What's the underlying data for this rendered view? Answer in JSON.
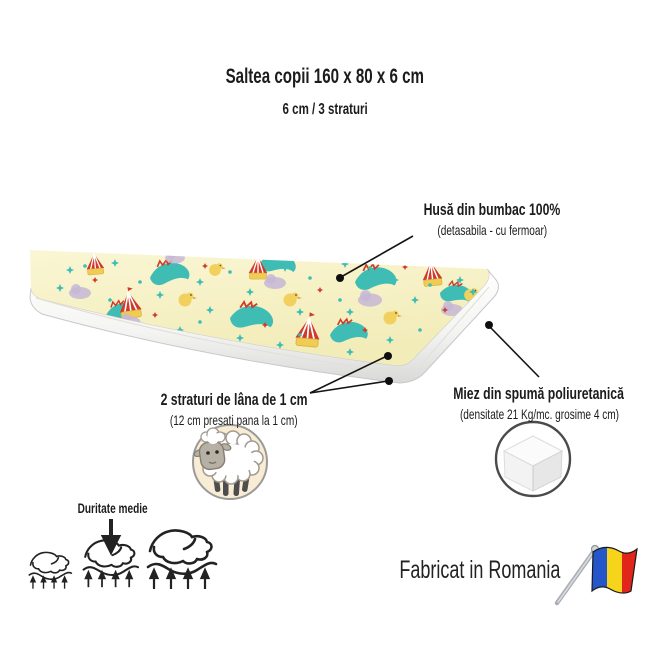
{
  "product": {
    "title": "Saltea copii 160 x 80 x 6 cm",
    "subtitle": "6 cm / 3 straturi"
  },
  "callouts": {
    "cover": {
      "title": "Husă din bumbac 100%",
      "note": "(detasabila - cu fermoar)"
    },
    "wool": {
      "title": "2 straturi de lâna de 1 cm",
      "note": "(12 cm presati pana la 1 cm)"
    },
    "foam": {
      "title": "Miez din spumă poliuretanică",
      "note": "(densitate 21 Kg/mc. grosime 4 cm)"
    }
  },
  "firmness": {
    "label": "Duritate medie",
    "level": "medium",
    "icons": [
      "hand-press-small-icon",
      "hand-press-medium-icon",
      "hand-press-large-icon"
    ]
  },
  "origin": {
    "label": "Fabricat in Romania",
    "flag": "romania-flag-icon"
  },
  "badges": {
    "wool_badge": "sheep-icon",
    "foam_badge": "foam-block-icon"
  },
  "colors": {
    "text": "#1c1c1c",
    "mattress_top": "#f7f2c6",
    "pattern_teal": "#3fbdb5",
    "pattern_red": "#cf3a2a",
    "pattern_yellow": "#f0cc55",
    "pattern_purple": "#c6b7d6",
    "side_white": "#ffffff",
    "badge_bg": "#f8ecd4",
    "flag_blue": "#2456c9",
    "flag_yellow": "#f6d41c",
    "flag_red": "#e1251b"
  }
}
